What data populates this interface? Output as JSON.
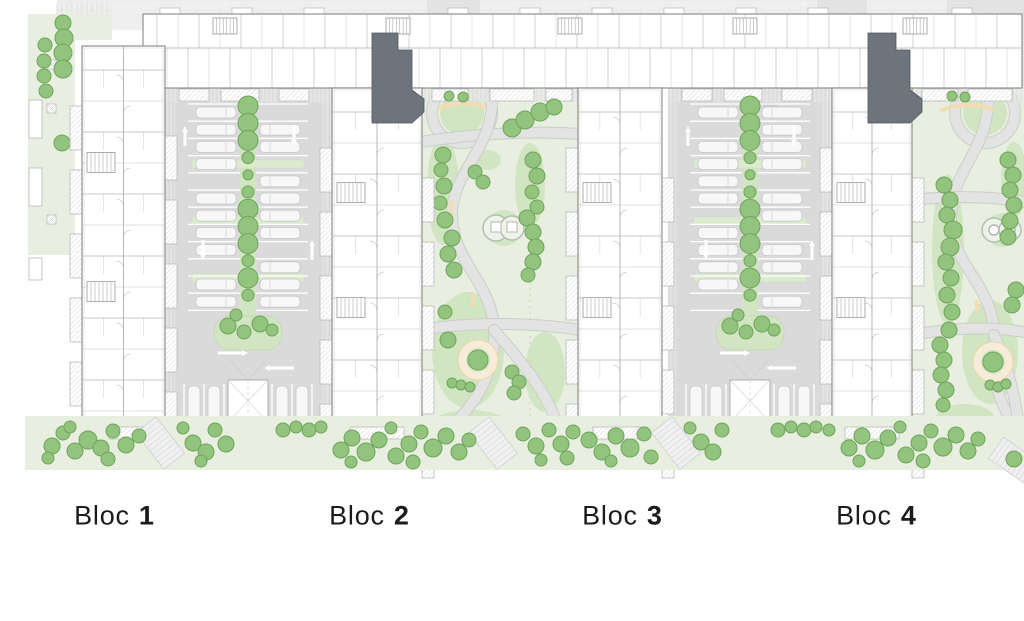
{
  "labels": [
    {
      "name": "Bloc",
      "number": "1",
      "x": 114,
      "y": 516
    },
    {
      "name": "Bloc",
      "number": "2",
      "x": 369,
      "y": 516
    },
    {
      "name": "Bloc",
      "number": "3",
      "x": 622,
      "y": 516
    },
    {
      "name": "Bloc",
      "number": "4",
      "x": 876,
      "y": 516
    }
  ],
  "colors": {
    "road": "#eeefee",
    "roadDark": "#e2e3e2",
    "roadLine": "#e4e6e4",
    "buildingFill": "#ffffff",
    "buildingStroke": "#8f8f8f",
    "wallLight": "#b5b5b5",
    "spine": "#a6a6a6",
    "core": "#6d747c",
    "coreStroke": "#51565c",
    "parking": "#dadada",
    "stallLine": "#ffffff",
    "car": "#f7f7f7",
    "carStroke": "#c6c6c6",
    "walkHatch": "#cfcfcf",
    "padStroke": "#b9b9b9",
    "parkBg": "#e8efe1",
    "lawn": "#d2e5c2",
    "path": "#e3e3e3",
    "pathCase": "#c9cfc6",
    "tree": "#92c47d",
    "treeStroke": "#6ea45b",
    "hedge": "#dcead0",
    "hedgeStroke": "#c2d5ae",
    "beige": "#f0ddb4",
    "ringFill": "#f6ecd7",
    "ringStroke": "#e9d6ab",
    "white": "#ffffff",
    "arrow": "#ffffff"
  },
  "plan": {
    "topBand": {
      "x": 57,
      "y": 0,
      "w": 967,
      "h": 30,
      "darkSegs": [
        [
          427,
          0,
          53,
          30
        ],
        [
          817,
          0,
          50,
          30
        ],
        [
          947,
          0,
          77,
          30
        ]
      ],
      "crosswalk": {
        "x1": 57,
        "x2": 112
      }
    },
    "rightRoad": {
      "x": 1012,
      "y": 14,
      "w": 12,
      "h": 170
    },
    "strip": {
      "main": {
        "x": 143,
        "y": 14,
        "w": 879,
        "h": 74
      },
      "stairsX": [
        213,
        386,
        558,
        733,
        903
      ],
      "bumpStart": 160,
      "bumpStep": 72,
      "bumpSkip": [
        [
          350,
          430
        ],
        [
          845,
          925
        ]
      ]
    },
    "wings": [
      {
        "x": 82,
        "y": 46,
        "w": 83,
        "h": 380
      },
      {
        "x": 332,
        "y": 88,
        "w": 90,
        "h": 338
      },
      {
        "x": 578,
        "y": 88,
        "w": 84,
        "h": 338
      },
      {
        "x": 832,
        "y": 88,
        "w": 80,
        "h": 338
      }
    ],
    "cores": [
      "372,33 398,33 398,50 412,50 412,90 424,99 424,112 412,123 372,123",
      "868,33 896,33 896,50 910,50 910,90 922,99 922,112 910,123 868,123"
    ],
    "parkings": [
      {
        "x": 165,
        "y": 88,
        "w": 167,
        "cx": 248,
        "carL": [
          1,
          1,
          1,
          1,
          0,
          1,
          1,
          1,
          1,
          0,
          1,
          1
        ],
        "carR": [
          0,
          1,
          1,
          0,
          1,
          1,
          1,
          1,
          0,
          1,
          1,
          1
        ],
        "whiteRect": [
          276,
          441,
          62,
          21
        ]
      },
      {
        "x": 668,
        "y": 88,
        "w": 164,
        "cx": 750,
        "carL": [
          1,
          0,
          1,
          1,
          1,
          1,
          0,
          1,
          1,
          1,
          1,
          0
        ],
        "carR": [
          1,
          1,
          1,
          1,
          0,
          1,
          1,
          0,
          1,
          1,
          0,
          1
        ],
        "whiteRect": [
          773,
          444,
          62,
          22
        ],
        "grayRect": [
          763,
          103,
          14,
          10
        ]
      }
    ],
    "parks": [
      {
        "clip": [
          420,
          88,
          158,
          344
        ],
        "ring": [
          462,
          113,
          30
        ],
        "lawns": [
          [
            462,
            113,
            22,
            22
          ],
          [
            443,
            190,
            16,
            55
          ],
          [
            530,
            185,
            15,
            42
          ],
          [
            487,
            160,
            14,
            10
          ],
          [
            468,
            350,
            36,
            58
          ],
          [
            545,
            372,
            20,
            40
          ],
          [
            470,
            424,
            38,
            14
          ]
        ],
        "paths": [
          "M420,142 C460,136 520,130 580,134",
          "M492,96 C494,150 452,170 452,215 C452,265 498,285 494,340 C491,392 462,412 450,432",
          "M420,330 C470,322 530,322 580,330",
          "M494,330 C520,360 548,392 560,432"
        ],
        "bench": "M440,108 Q462,99 484,107",
        "sticks": [
          [
            449,
            200,
            4,
            16
          ],
          [
            471,
            293,
            4,
            14
          ]
        ],
        "peanut": {
          "c": [
            [
              496,
              228,
              13
            ],
            [
              512,
              228,
              12
            ]
          ],
          "squares": [
            [
              491,
              222,
              10,
              10
            ],
            [
              507,
              222,
              10,
              10
            ]
          ],
          "lawn": [
            504,
            228,
            18
          ]
        },
        "playground": [
          478,
          360
        ],
        "dash": [
          530,
          150,
          420
        ],
        "pads": [
          [
            432,
            89,
            36,
            12
          ],
          [
            490,
            89,
            44,
            12
          ],
          [
            546,
            89,
            26,
            12
          ]
        ],
        "trees": [
          [
            449,
            96,
            5
          ],
          [
            463,
            97,
            5
          ],
          [
            512,
            128,
            9
          ],
          [
            525,
            120,
            9
          ],
          [
            540,
            112,
            9
          ],
          [
            554,
            107,
            8
          ],
          [
            443,
            155,
            8
          ],
          [
            441,
            170,
            7
          ],
          [
            444,
            186,
            8
          ],
          [
            440,
            203,
            7
          ],
          [
            445,
            220,
            8
          ],
          [
            452,
            238,
            8
          ],
          [
            448,
            254,
            8
          ],
          [
            454,
            270,
            8
          ],
          [
            475,
            172,
            7
          ],
          [
            483,
            182,
            7
          ],
          [
            533,
            160,
            8
          ],
          [
            537,
            176,
            8
          ],
          [
            532,
            192,
            7
          ],
          [
            537,
            207,
            7
          ],
          [
            527,
            218,
            8
          ],
          [
            533,
            232,
            8
          ],
          [
            536,
            247,
            8
          ],
          [
            533,
            262,
            8
          ],
          [
            528,
            275,
            7
          ],
          [
            448,
            340,
            8
          ],
          [
            445,
            312,
            7
          ],
          [
            512,
            372,
            7
          ],
          [
            519,
            382,
            7
          ],
          [
            514,
            393,
            7
          ],
          [
            452,
            383,
            5
          ],
          [
            461,
            385,
            5
          ],
          [
            470,
            387,
            5
          ]
        ]
      },
      {
        "clip": [
          912,
          88,
          112,
          344
        ],
        "ring": [
          985,
          113,
          30
        ],
        "lawns": [
          [
            985,
            113,
            22,
            22
          ],
          [
            948,
            250,
            16,
            75
          ],
          [
            990,
            352,
            28,
            52
          ],
          [
            1014,
            180,
            13,
            38
          ],
          [
            965,
            420,
            30,
            16
          ]
        ],
        "paths": [
          "M988,96 C990,150 950,170 951,220 C952,270 998,285 994,345 C991,395 1008,412 1016,432",
          "M912,200 C950,196 990,196 1024,202",
          "M912,335 C950,328 990,326 1024,332",
          "M994,335 C1005,360 1014,390 1018,420"
        ],
        "bench": "M942,110 Q966,101 992,109",
        "sticks": [
          [
            955,
            238,
            4,
            16
          ],
          [
            975,
            300,
            4,
            12
          ]
        ],
        "peanut": {
          "c": [
            [
              994,
              230,
              12
            ],
            [
              1010,
              230,
              11
            ]
          ],
          "circles": [
            [
              994,
              230,
              5
            ],
            [
              1010,
              230,
              5
            ]
          ],
          "lawn": [
            1002,
            230,
            17
          ]
        },
        "playground": [
          993,
          362
        ],
        "pads": [
          [
            922,
            89,
            36,
            12
          ],
          [
            968,
            89,
            44,
            12
          ]
        ],
        "trees": [
          [
            952,
            96,
            5
          ],
          [
            965,
            97,
            5
          ],
          [
            944,
            185,
            8
          ],
          [
            950,
            200,
            8
          ],
          [
            947,
            215,
            8
          ],
          [
            953,
            230,
            9
          ],
          [
            950,
            247,
            9
          ],
          [
            946,
            262,
            8
          ],
          [
            951,
            278,
            8
          ],
          [
            947,
            295,
            8
          ],
          [
            952,
            312,
            8
          ],
          [
            949,
            330,
            8
          ],
          [
            1008,
            160,
            8
          ],
          [
            1013,
            175,
            8
          ],
          [
            1010,
            190,
            8
          ],
          [
            1014,
            205,
            8
          ],
          [
            1010,
            221,
            8
          ],
          [
            1008,
            237,
            8
          ],
          [
            1016,
            290,
            8
          ],
          [
            1012,
            305,
            8
          ],
          [
            940,
            345,
            8
          ],
          [
            944,
            360,
            8
          ],
          [
            941,
            375,
            8
          ],
          [
            946,
            390,
            8
          ],
          [
            943,
            405,
            7
          ],
          [
            990,
            385,
            5
          ],
          [
            998,
            387,
            5
          ],
          [
            1006,
            384,
            5
          ]
        ]
      }
    ],
    "leftStrip": {
      "rects": [
        [
          28,
          14,
          84,
          26
        ],
        [
          28,
          40,
          47,
          215
        ]
      ],
      "pads": [
        [
          29,
          100,
          13,
          38
        ],
        [
          29,
          168,
          13,
          38
        ],
        [
          29,
          258,
          13,
          22
        ]
      ],
      "squares": [
        [
          47,
          60,
          9
        ],
        [
          47,
          104,
          9
        ],
        [
          47,
          215,
          9
        ]
      ],
      "trees": [
        [
          63,
          23,
          8
        ],
        [
          64,
          38,
          9
        ],
        [
          45,
          45,
          7
        ],
        [
          63,
          53,
          9
        ],
        [
          44,
          61,
          7
        ],
        [
          63,
          69,
          9
        ],
        [
          44,
          76,
          7
        ],
        [
          46,
          91,
          7
        ],
        [
          62,
          143,
          8
        ]
      ]
    },
    "bottomStrip": {
      "band": [
        25,
        416,
        999,
        54
      ],
      "buildingPads": [
        [
          109,
          427
        ],
        [
          350,
          427
        ],
        [
          593,
          427
        ],
        [
          845,
          427
        ]
      ],
      "steps": [
        [
          147,
          420,
          -38
        ],
        [
          480,
          420,
          -38
        ],
        [
          663,
          420,
          -38
        ],
        [
          1002,
          438,
          -55
        ]
      ],
      "trees": [
        [
          52,
          446,
          8
        ],
        [
          63,
          433,
          7
        ],
        [
          75,
          451,
          8
        ],
        [
          88,
          440,
          9
        ],
        [
          70,
          427,
          6
        ],
        [
          101,
          448,
          8
        ],
        [
          113,
          431,
          7
        ],
        [
          126,
          445,
          8
        ],
        [
          139,
          436,
          7
        ],
        [
          48,
          458,
          6
        ],
        [
          108,
          459,
          7
        ],
        [
          183,
          428,
          6
        ],
        [
          193,
          443,
          8
        ],
        [
          206,
          452,
          8
        ],
        [
          215,
          430,
          7
        ],
        [
          226,
          444,
          8
        ],
        [
          201,
          461,
          6
        ],
        [
          283,
          430,
          7
        ],
        [
          296,
          427,
          6
        ],
        [
          309,
          430,
          7
        ],
        [
          321,
          427,
          6
        ],
        [
          341,
          450,
          8
        ],
        [
          352,
          438,
          8
        ],
        [
          366,
          452,
          9
        ],
        [
          379,
          440,
          8
        ],
        [
          391,
          428,
          6
        ],
        [
          396,
          456,
          8
        ],
        [
          409,
          444,
          8
        ],
        [
          421,
          432,
          7
        ],
        [
          433,
          448,
          9
        ],
        [
          446,
          436,
          8
        ],
        [
          459,
          452,
          8
        ],
        [
          469,
          440,
          7
        ],
        [
          351,
          462,
          6
        ],
        [
          413,
          462,
          7
        ],
        [
          523,
          434,
          7
        ],
        [
          536,
          446,
          8
        ],
        [
          549,
          430,
          7
        ],
        [
          561,
          444,
          8
        ],
        [
          573,
          432,
          7
        ],
        [
          541,
          460,
          6
        ],
        [
          567,
          458,
          7
        ],
        [
          589,
          440,
          8
        ],
        [
          602,
          452,
          8
        ],
        [
          616,
          436,
          8
        ],
        [
          630,
          448,
          9
        ],
        [
          644,
          434,
          7
        ],
        [
          611,
          461,
          6
        ],
        [
          651,
          457,
          7
        ],
        [
          690,
          428,
          6
        ],
        [
          701,
          442,
          8
        ],
        [
          713,
          452,
          8
        ],
        [
          722,
          430,
          7
        ],
        [
          778,
          430,
          7
        ],
        [
          791,
          427,
          6
        ],
        [
          804,
          430,
          7
        ],
        [
          816,
          427,
          6
        ],
        [
          829,
          430,
          6
        ],
        [
          849,
          448,
          8
        ],
        [
          862,
          436,
          8
        ],
        [
          875,
          450,
          9
        ],
        [
          888,
          438,
          8
        ],
        [
          900,
          427,
          6
        ],
        [
          906,
          455,
          8
        ],
        [
          919,
          443,
          8
        ],
        [
          931,
          431,
          7
        ],
        [
          943,
          447,
          9
        ],
        [
          956,
          435,
          8
        ],
        [
          968,
          451,
          8
        ],
        [
          978,
          439,
          7
        ],
        [
          859,
          461,
          6
        ],
        [
          923,
          461,
          7
        ],
        [
          1014,
          459,
          8
        ]
      ]
    }
  }
}
